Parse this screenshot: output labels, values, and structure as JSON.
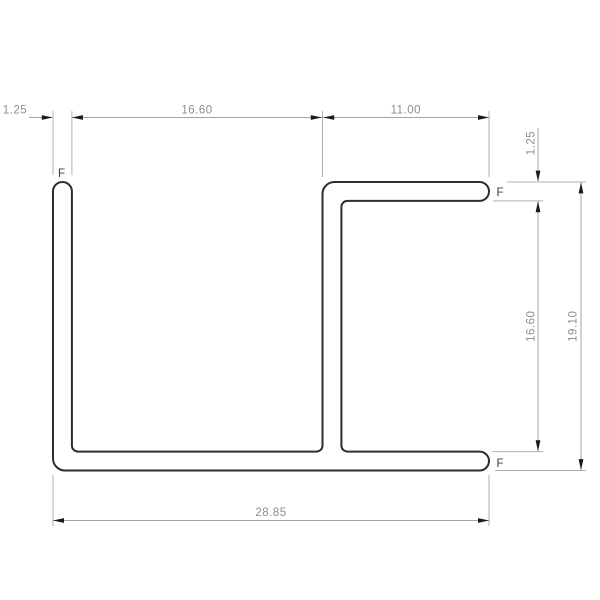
{
  "drawing": {
    "type": "technical-cross-section",
    "part_labels": [
      "F",
      "F",
      "F"
    ],
    "dimensions": {
      "left_wall_thickness": "1.25",
      "channel_opening_width": "16.60",
      "top_flange_width": "11.00",
      "top_wall_thickness": "1.25",
      "inner_height": "16.60",
      "overall_height": "19.10",
      "overall_width": "28.85"
    },
    "colors": {
      "outline": "#2e2e2e",
      "dimension_line": "#a3a3a3",
      "extension_line": "#b0b0b0",
      "arrow": "#1a1a1a",
      "dimension_text": "#8f8f8f",
      "label_text": "#3c3c3c",
      "background": "#ffffff"
    }
  }
}
